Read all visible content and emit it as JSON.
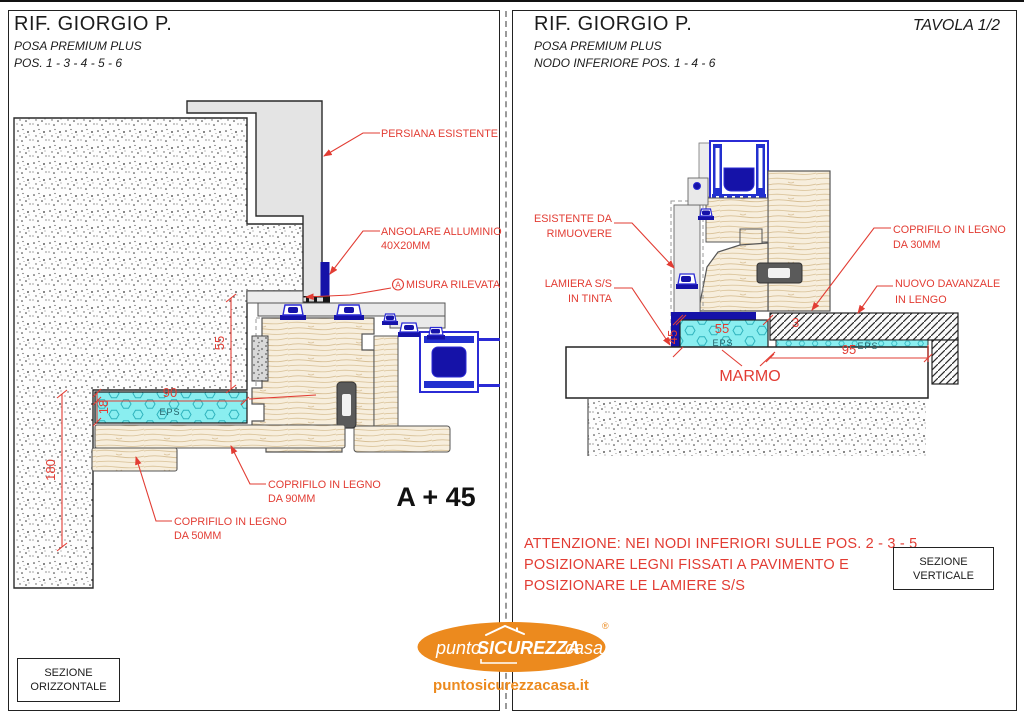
{
  "left_panel": {
    "title": "RIF. GIORGIO P.",
    "subtitle": "POSA PREMIUM PLUS",
    "position": "POS. 1 - 3 - 4 - 5 - 6",
    "labels": {
      "persiana": "PERSIANA ESISTENTE",
      "angolare_1": "ANGOLARE ALLUMINIO",
      "angolare_2": "40X20MM",
      "misura_marker": "A",
      "misura": "MISURA RILEVATA",
      "coprifilo90_1": "COPRIFILO IN LEGNO",
      "coprifilo90_2": "DA 90MM",
      "coprifilo50_1": "COPRIFILO IN LEGNO",
      "coprifilo50_2": "DA 50MM",
      "eps": "EPS"
    },
    "dimensions": {
      "d55": "55",
      "d18": "18",
      "d90": "90",
      "d180": "180"
    },
    "note": "A + 45",
    "section_box": [
      "SEZIONE",
      "ORIZZONTALE"
    ]
  },
  "right_panel": {
    "title": "RIF. GIORGIO P.",
    "subtitle": "POSA PREMIUM PLUS",
    "position": "NODO INFERIORE POS. 1 - 4 - 6",
    "tavola": "TAVOLA 1/2",
    "labels": {
      "esistente_1": "ESISTENTE DA",
      "esistente_2": "RIMUOVERE",
      "lamiera_1": "LAMIERA S/S",
      "lamiera_2": "IN TINTA",
      "coprifilo30_1": "COPRIFILO IN LEGNO",
      "coprifilo30_2": "DA 30MM",
      "davanzale_1": "NUOVO DAVANZALE",
      "davanzale_2": "IN LENGO",
      "marmo": "MARMO",
      "eps1": "EPS",
      "eps2": "EPS"
    },
    "dimensions": {
      "d45": "45",
      "d55": "55",
      "d3": "3",
      "d95": "95"
    },
    "attention": [
      "ATTENZIONE: NEI NODI INFERIORI SULLE POS. 2 - 3 - 5",
      "POSIZIONARE LEGNI FISSATI A PAVIMENTO E",
      "POSIZIONARE LE LAMIERE S/S"
    ],
    "section_box": [
      "SEZIONE",
      "VERTICALE"
    ]
  },
  "footer": {
    "logo": {
      "part1": "punto",
      "part2": "SICUREZZA",
      "part3": "casa",
      "reg": "®"
    },
    "website": "puntosicurezzacasa.it"
  },
  "colors": {
    "annotation_red": "#e23c33",
    "eps_cyan": "#8aeef0",
    "hardware_blue": "#2b2bd5",
    "navy": "#1512a8",
    "wood": "#f7eedd",
    "brand_orange": "#ec8a1e"
  }
}
